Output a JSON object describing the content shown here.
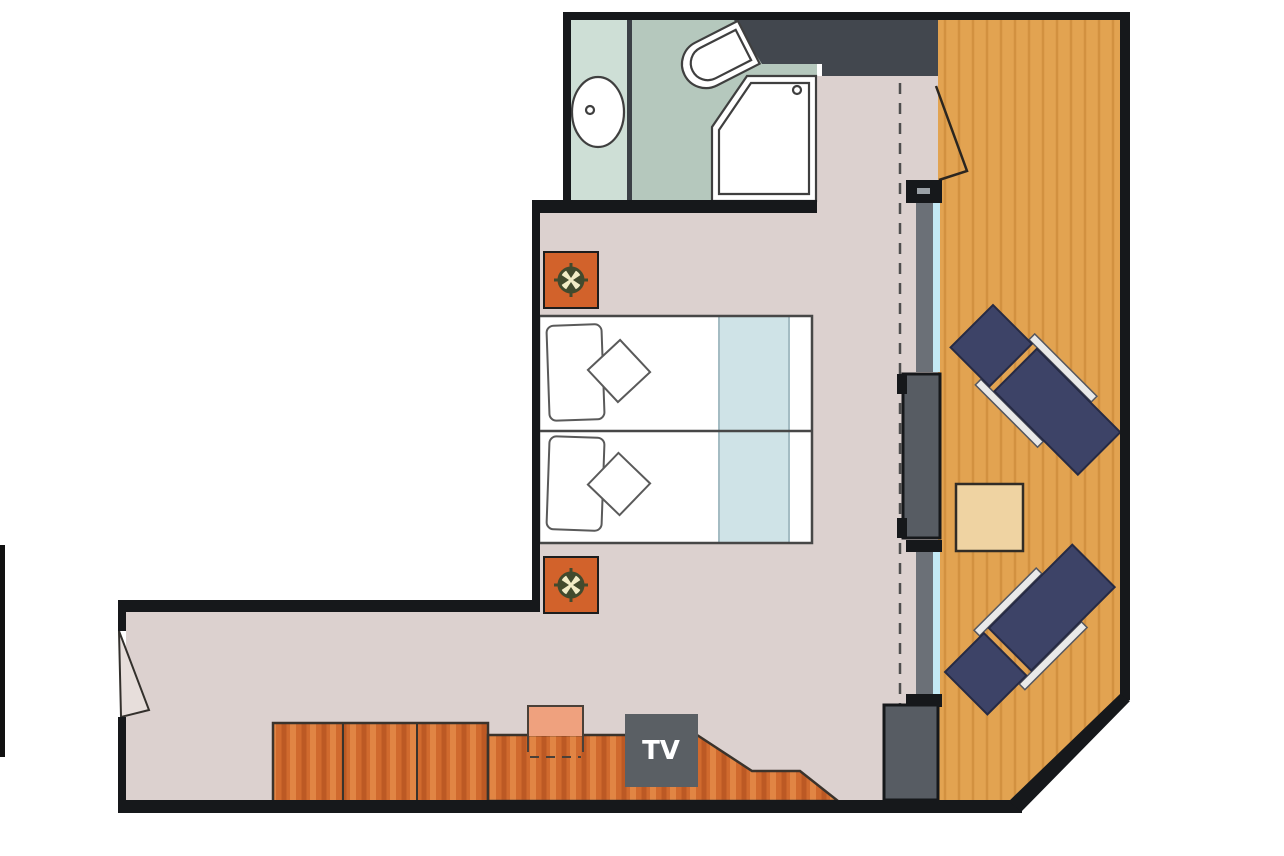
{
  "labels": {
    "tv": "TV"
  },
  "icons": {
    "ceiling_light": "compass-rose-light-symbol",
    "tv_unit": "tv-box-with-label",
    "entry_door": "open-door-leaf",
    "balcony_door": "open-door-swing-line",
    "curtain": "dashed-curtain-line"
  },
  "palette": {
    "wall": "#16181b",
    "floor": "#dcd1cf",
    "mint": "#cedfd6",
    "sage": "#b5c8bd",
    "bathDivider": "#3b4046",
    "darkWall": "#42474e",
    "doorGray": "#575c63",
    "frameGray": "#6b7077",
    "glass": "#c4e9f4",
    "wood": "#e2a351",
    "woodGrain": "#d29140",
    "cab": "#d06a2e",
    "cabDark": "#b5521f",
    "cabLight": "#e58c4a",
    "navy": "#3d4367",
    "navyEdge": "#262a44",
    "rail": "#e9e9e9",
    "table": "#efd3a2",
    "nightstand": "#d2622b",
    "iconCream": "#f2ecc6",
    "iconDark": "#424a2d",
    "tvBox": "#5a5f64",
    "tvText": "#ffffff",
    "runner": "#cfe3e7",
    "stool": "#efa17e",
    "outline": "#3f3f3f",
    "capLabel": "#9aa0a6"
  }
}
